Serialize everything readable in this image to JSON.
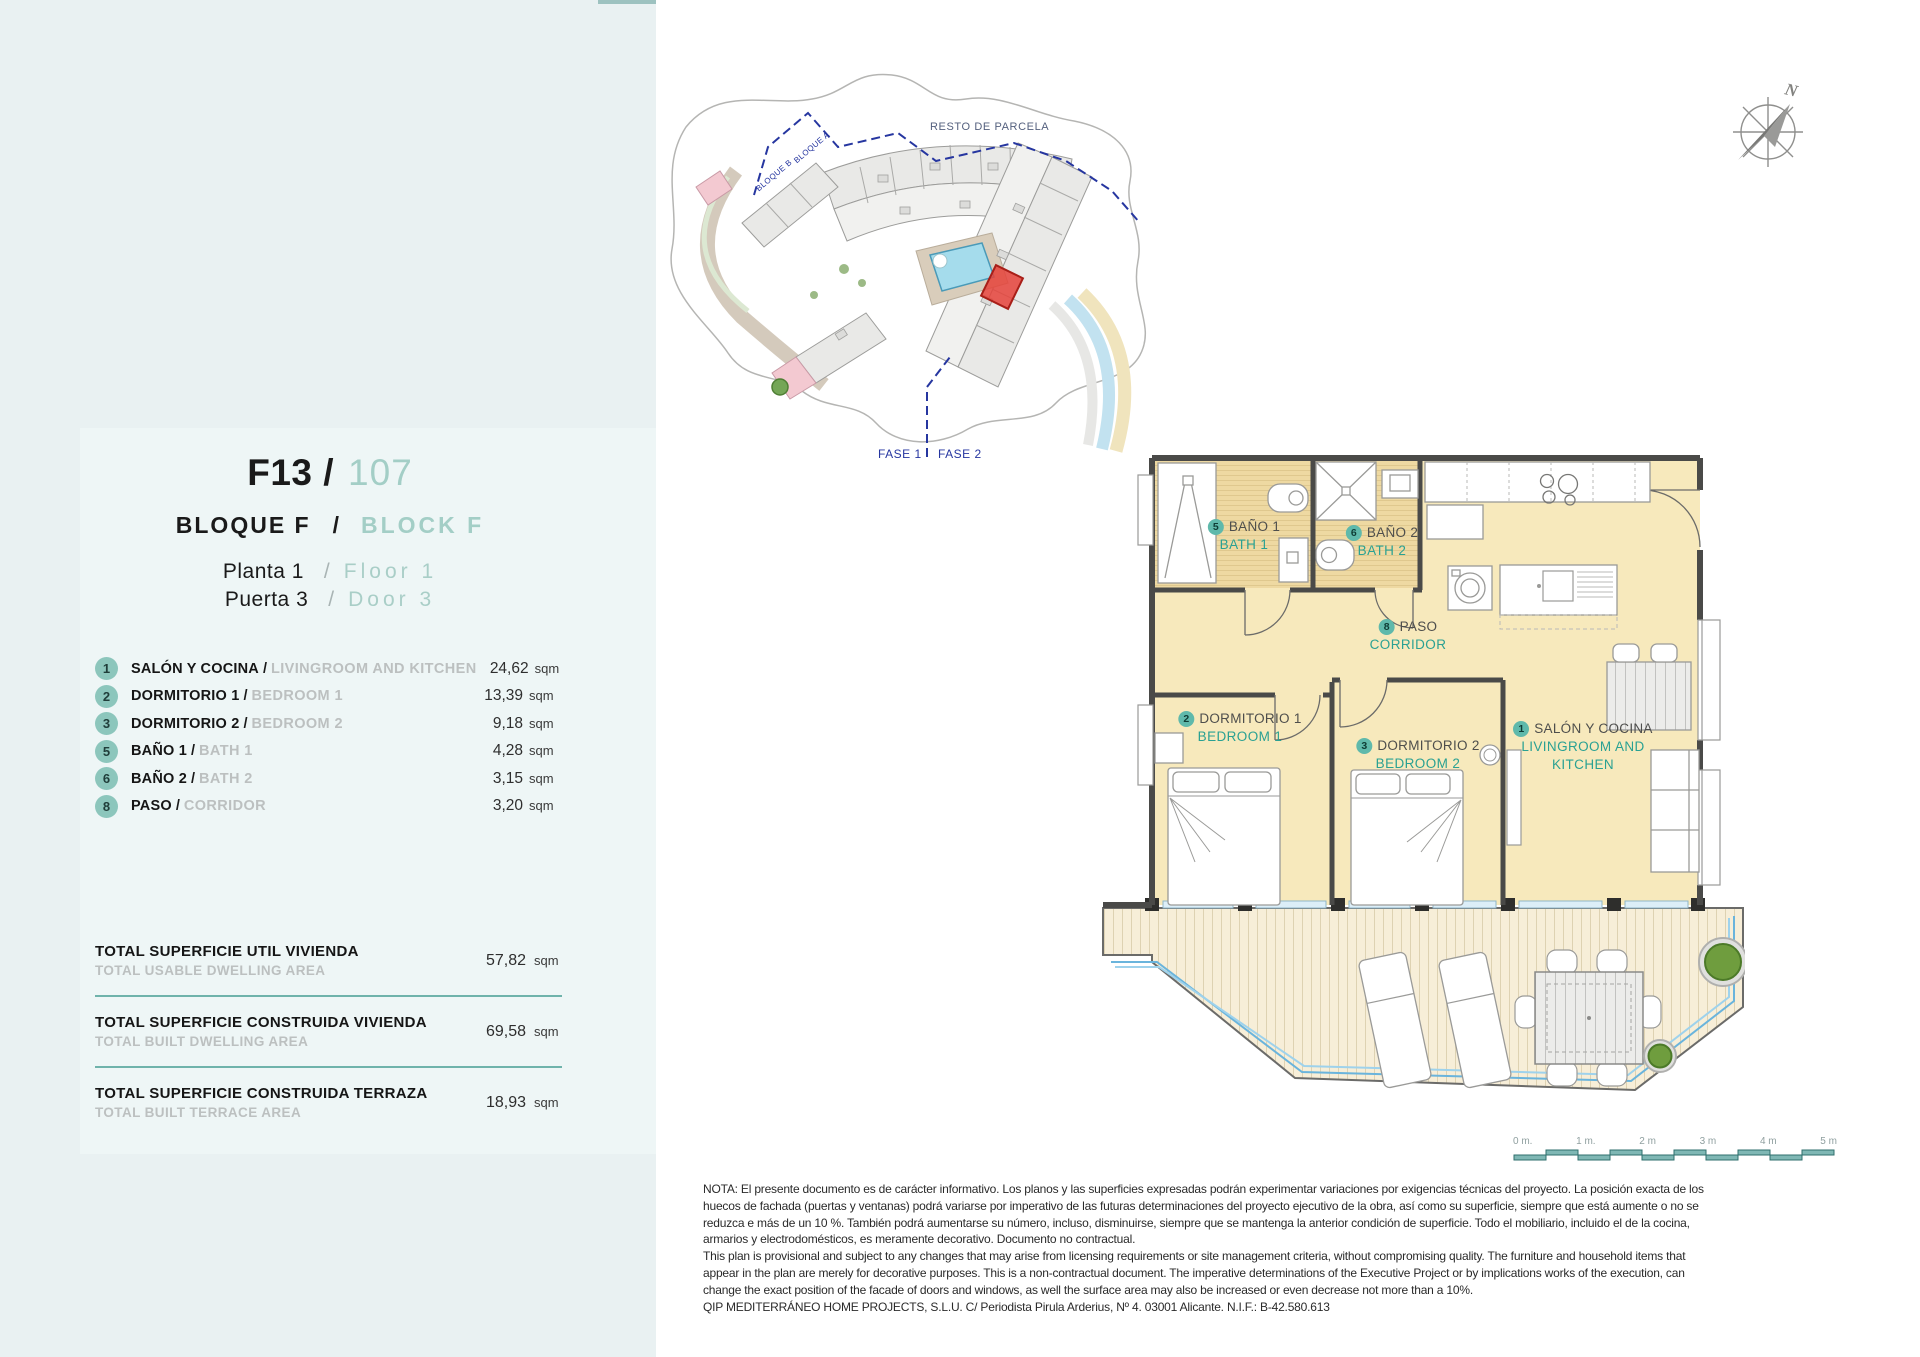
{
  "left_panel": {
    "unit_code": "F13",
    "unit_sep": "/",
    "unit_number": "107",
    "block_es": "BLOQUE  F",
    "block_sep": "/",
    "block_en": "BLOCK  F",
    "floor_es": "Planta 1",
    "floor_sep": "/",
    "floor_en": "Floor  1",
    "door_es": "Puerta 3",
    "door_sep": "/",
    "door_en": "Door  3",
    "room_sep": "/",
    "rooms": [
      {
        "num": "1",
        "es": "SALÓN Y COCINA",
        "en": "LIVINGROOM AND KITCHEN",
        "area": "24,62",
        "unit": "sqm"
      },
      {
        "num": "2",
        "es": "DORMITORIO 1",
        "en": "BEDROOM 1",
        "area": "13,39",
        "unit": "sqm"
      },
      {
        "num": "3",
        "es": "DORMITORIO 2",
        "en": "BEDROOM 2",
        "area": "9,18",
        "unit": "sqm"
      },
      {
        "num": "5",
        "es": "BAÑO 1",
        "en": "BATH 1",
        "area": "4,28",
        "unit": "sqm"
      },
      {
        "num": "6",
        "es": "BAÑO 2",
        "en": "BATH 2",
        "area": "3,15",
        "unit": "sqm"
      },
      {
        "num": "8",
        "es": "PASO",
        "en": "CORRIDOR",
        "area": "3,20",
        "unit": "sqm"
      }
    ],
    "totals": [
      {
        "es": "TOTAL SUPERFICIE UTIL VIVIENDA",
        "en": "TOTAL USABLE DWELLING AREA",
        "value": "57,82",
        "unit": "sqm"
      },
      {
        "es": "TOTAL SUPERFICIE CONSTRUIDA VIVIENDA",
        "en": "TOTAL BUILT DWELLING AREA",
        "value": "69,58",
        "unit": "sqm"
      },
      {
        "es": "TOTAL SUPERFICIE CONSTRUIDA TERRAZA",
        "en": "TOTAL BUILT TERRACE AREA",
        "value": "18,93",
        "unit": "sqm"
      }
    ]
  },
  "floor_plan": {
    "rooms": [
      {
        "num": "1",
        "es": "SALÓN Y COCINA",
        "en": "LIVINGROOM AND KITCHEN"
      },
      {
        "num": "2",
        "es": "DORMITORIO 1",
        "en": "BEDROOM 1"
      },
      {
        "num": "3",
        "es": "DORMITORIO 2",
        "en": "BEDROOM 2"
      },
      {
        "num": "5",
        "es": "BAÑO 1",
        "en": "BATH 1"
      },
      {
        "num": "6",
        "es": "BAÑO 2",
        "en": "BATH 2"
      },
      {
        "num": "8",
        "es": "PASO",
        "en": "CORRIDOR"
      }
    ]
  },
  "site_plan": {
    "resto_label": "RESTO DE PARCELA",
    "bloque_a_label": "BLOQUE A",
    "bloque_b_label": "BLOQUE B",
    "fase1_label": "FASE 1",
    "fase2_label": "FASE 2"
  },
  "compass": {
    "label": "N"
  },
  "scale_bar": {
    "labels": [
      "0 m.",
      "1 m.",
      "2 m",
      "3 m",
      "4 m",
      "5 m"
    ]
  },
  "disclaimer": {
    "lines": [
      "NOTA: El presente documento es de carácter informativo. Los planos y las superficies expresadas podrán experimentar variaciones por exigencias técnicas del proyecto. La posición exacta de los",
      "huecos de fachada (puertas y ventanas) podrá variarse por imperativo de las futuras determinaciones del proyecto ejecutivo de la obra, así como su superficie, siempre que está aumente o no se",
      "reduzca e más de un 10 %. También podrá aumentarse su número, incluso, disminuirse, siempre que se mantenga la anterior condición de superficie. Todo el mobiliario, incluido el de la cocina,",
      "armarios y electrodomésticos, es meramente decorativo. Documento no contractual.",
      "This plan is provisional and subject to any changes that may arise from licensing requirements or site management criteria, without compromising quality. The furniture and household items that",
      "appear in the plan are merely for decorative purposes. This is a non-contractual document. The imperative determinations of the Executive Project or by implications works of the execution, can",
      "change the exact position of the facade of doors and windows, as well the surface area may also be increased or even decrease not more than a 10%.",
      "QIP MEDITERRÁNEO HOME PROJECTS, S.L.U. C/ Periodista Pirula Arderius, Nº 4. 03001 Alicante. N.I.F.: B-42.580.613"
    ]
  },
  "colors": {
    "accent_teal": "#8cc6bc",
    "panel_bg": "#e9f1f2",
    "plan_room_fill": "#f7e9bc",
    "bath_floor": "#eed9a2",
    "highlight_red": "#e5423a",
    "rail_blue": "#6ab4dc",
    "wall": "#4a4a48"
  }
}
